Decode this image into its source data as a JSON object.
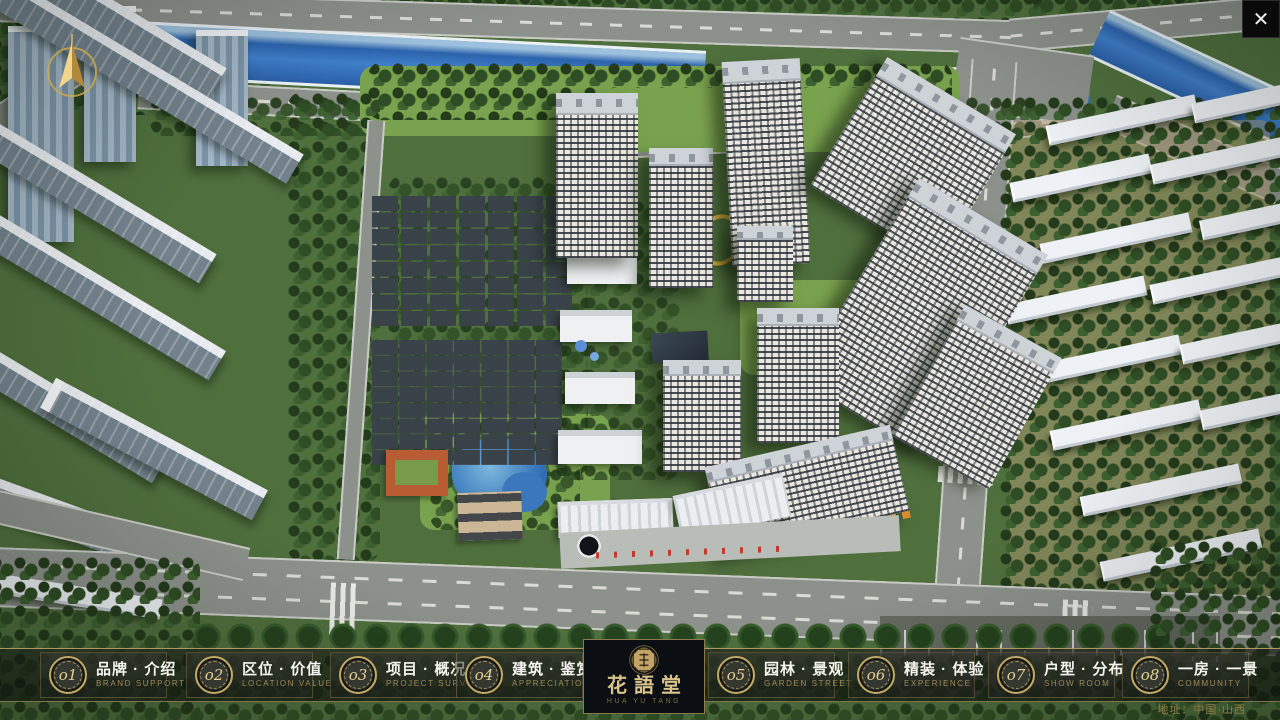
{
  "chrome": {
    "icons": {
      "close": "✕"
    }
  },
  "nav": {
    "items": [
      {
        "num": "o1",
        "label": "品牌 · 介绍",
        "sub": "BRAND SUPPORT"
      },
      {
        "num": "o2",
        "label": "区位 · 价值",
        "sub": "LOCATION VALUE"
      },
      {
        "num": "o3",
        "label": "项目 · 概况",
        "sub": "PROJECT SURVEY"
      },
      {
        "num": "o4",
        "label": "建筑 · 鉴赏",
        "sub": "APPRECIATION"
      },
      {
        "num": "o5",
        "label": "园林 · 景观",
        "sub": "GARDEN STREET"
      },
      {
        "num": "o6",
        "label": "精装 · 体验",
        "sub": "EXPERIENCE"
      },
      {
        "num": "o7",
        "label": "户型 · 分布",
        "sub": "SHOW ROOM"
      },
      {
        "num": "o8",
        "label": "一房 · 一景",
        "sub": "COMMUNITY"
      }
    ]
  },
  "logo": {
    "title": "花語堂",
    "tagline": "HUA YU TANG"
  },
  "footer": {
    "address": "地址：中国·山西"
  },
  "colors": {
    "accent_gold": "#c8ad6c",
    "nav_text": "#f5f5f0",
    "nav_subtitle": "#9c8b57",
    "bar_border": "#9a8a5c",
    "logo_text": "#d9c38b",
    "water": "#3f7fca",
    "foliage": "#2f4d24"
  }
}
